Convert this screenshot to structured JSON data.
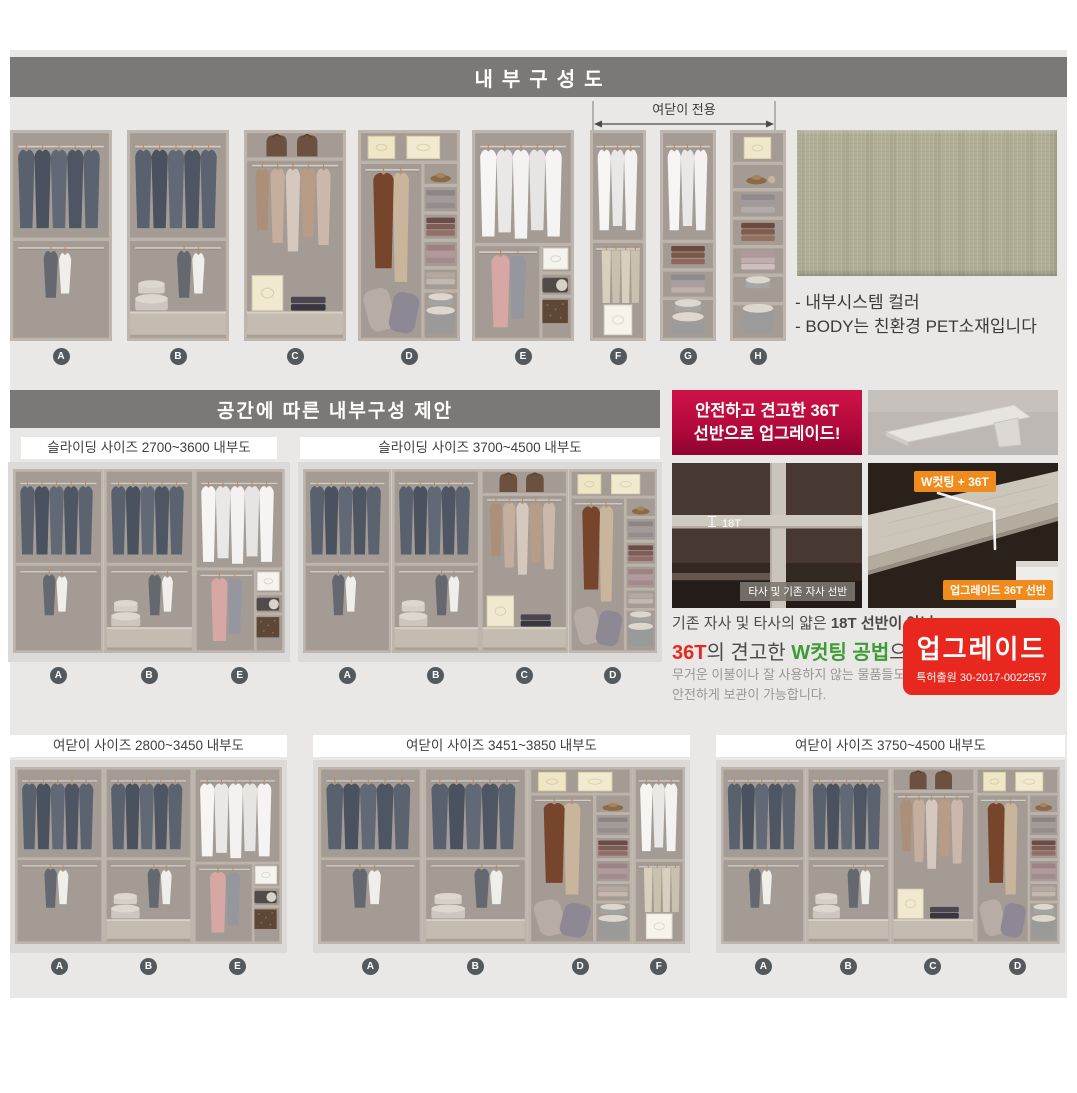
{
  "header": {
    "title": "내부구성도",
    "section2_title": "공간에 따른 내부구성 제안"
  },
  "top_row": {
    "bracket_label": "여닫이 전용",
    "units": [
      {
        "label": "A"
      },
      {
        "label": "B"
      },
      {
        "label": "C"
      },
      {
        "label": "D"
      },
      {
        "label": "E"
      },
      {
        "label": "F"
      },
      {
        "label": "G"
      },
      {
        "label": "H"
      }
    ]
  },
  "swatch": {
    "color": "#b1af96",
    "note1": "- 내부시스템 컬러",
    "note2": "- BODY는 친환경 PET소재입니다"
  },
  "panels": [
    {
      "id": "mid-left",
      "title": "슬라이딩 사이즈 2700~3600 내부도",
      "sections": [
        "A",
        "B",
        "E"
      ]
    },
    {
      "id": "mid-right",
      "title": "슬라이딩 사이즈 3700~4500 내부도",
      "sections": [
        "A",
        "B",
        "C",
        "D"
      ]
    },
    {
      "id": "bottom-left",
      "title": "여닫이 사이즈 2800~3450 내부도",
      "sections": [
        "A",
        "B",
        "E"
      ]
    },
    {
      "id": "bottom-mid",
      "title": "여닫이 사이즈 3451~3850 내부도",
      "sections": [
        "A",
        "B",
        "D",
        "F"
      ]
    },
    {
      "id": "bottom-right",
      "title": "여닫이 사이즈 3750~4500 내부도",
      "sections": [
        "A",
        "B",
        "C",
        "D"
      ]
    }
  ],
  "upgrade": {
    "badge_line1": "안전하고 견고한 36T",
    "badge_line2": "선반으로 업그레이드!",
    "old_dim_label": "18T",
    "old_caption": "타사 및 기존 자사 선반",
    "new_tag": "W컷팅 + 36T",
    "new_caption": "업그레이드 36T 선반",
    "desc1_normal": "기존 자사 및 타사의 얇은 ",
    "desc1_bold": "18T 선반이 아닌",
    "desc2_red": "36T",
    "desc2_mid": "의 견고한 ",
    "desc2_green": "W컷팅 공법",
    "desc2_end": "으로",
    "desc_sub1": "무거운 이불이나 잘 사용하지 않는 물품들도",
    "desc_sub2": "안전하게 보관이 가능합니다.",
    "stamp_title": "업그레이드",
    "stamp_sub": "특허출원 30-2017-0022557",
    "accent_red": "#e8281e",
    "accent_green": "#3f9c35",
    "badge_red": "#c60b3e",
    "tag_orange": "#f08c1e"
  }
}
